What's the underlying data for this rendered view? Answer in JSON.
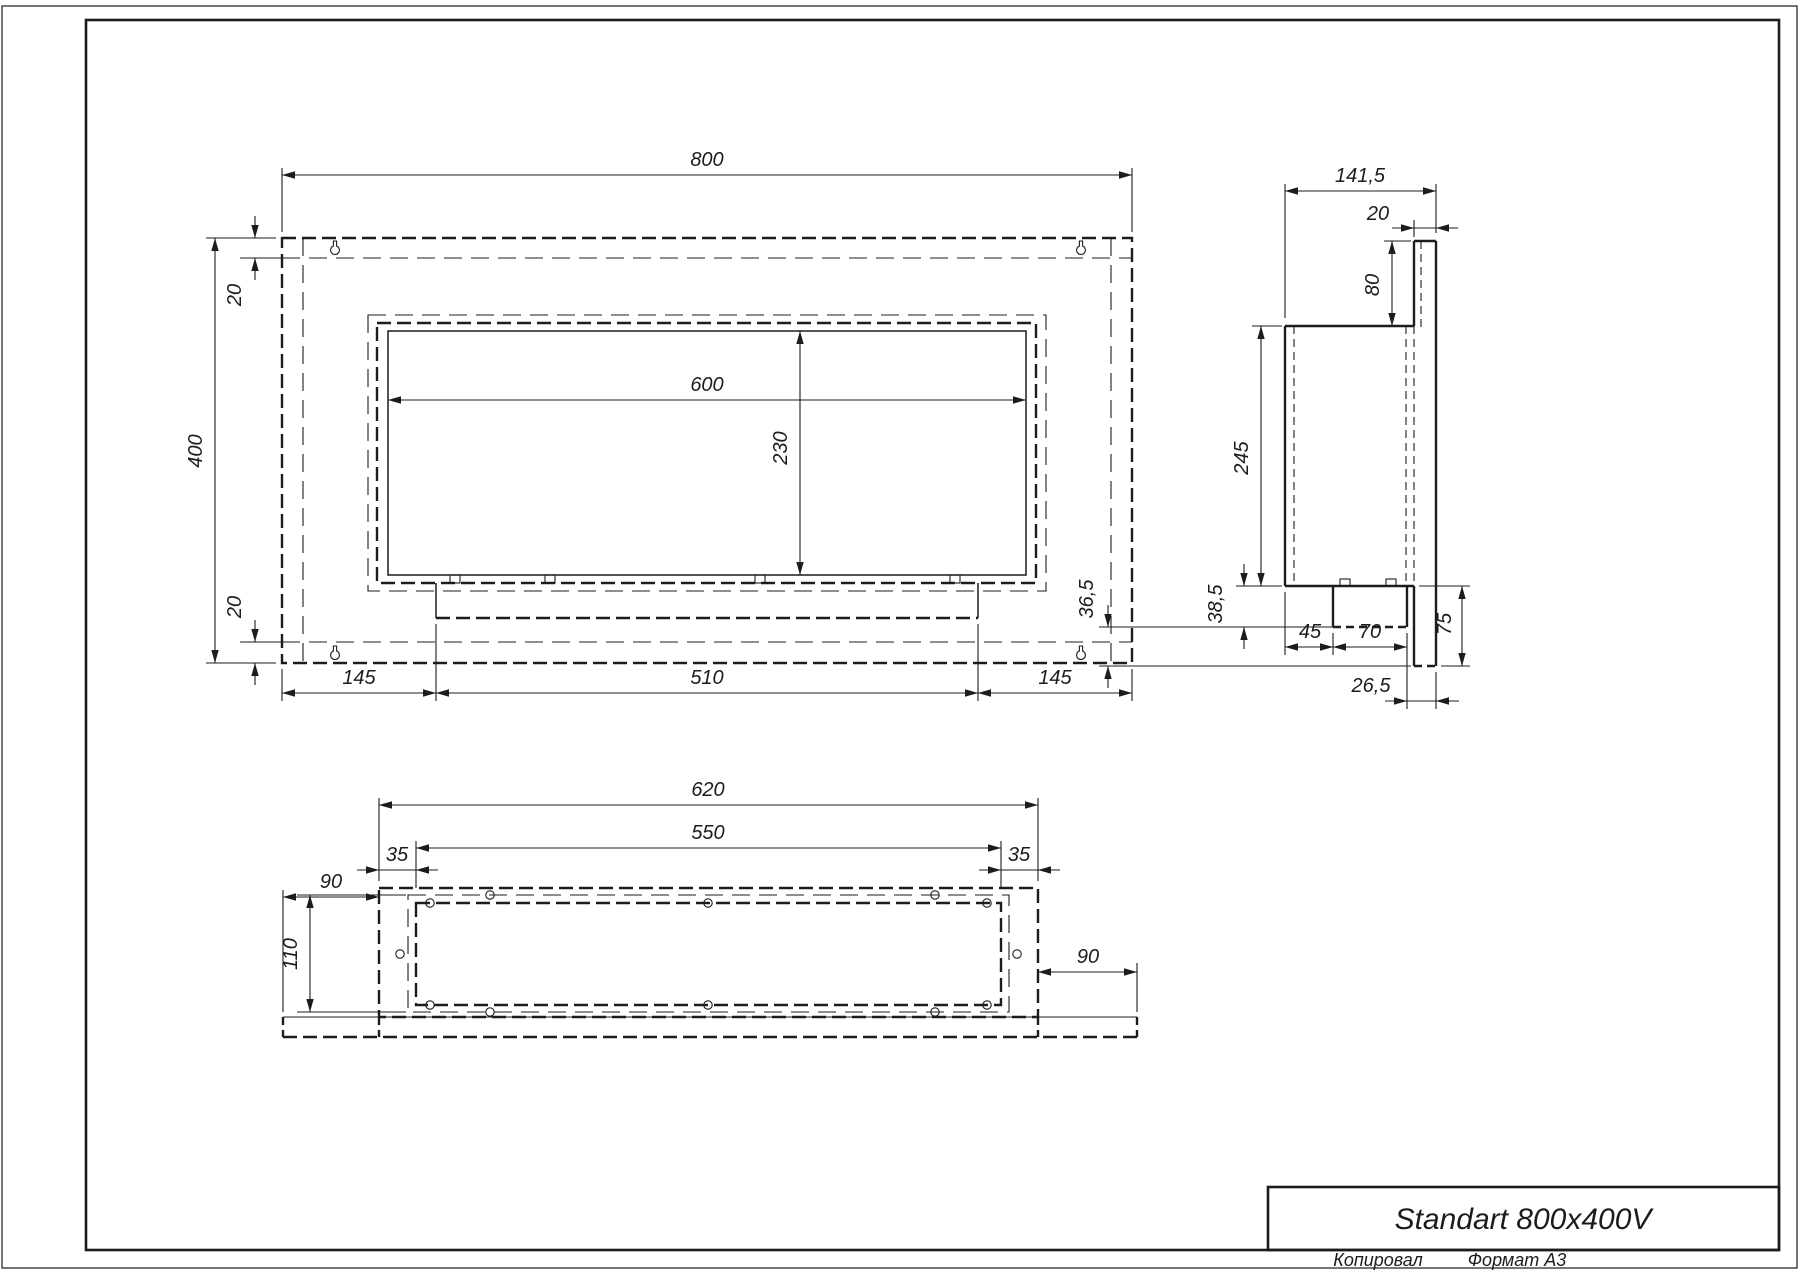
{
  "drawing": {
    "title": "Standart 800x400V",
    "footer": {
      "copied_by": "Копировал",
      "format": "Формат А3"
    },
    "colors": {
      "line": "#1c1c1c",
      "background": "#ffffff"
    },
    "front_view": {
      "overall_width": "800",
      "overall_height": "400",
      "top_inset": "20",
      "bottom_inset": "20",
      "opening_width": "600",
      "opening_height": "230",
      "left_offset": "145",
      "burner_width": "510",
      "right_offset": "145"
    },
    "side_view": {
      "overall_depth": "141,5",
      "back_panel_thickness": "20",
      "top_offset": "80",
      "body_height": "245",
      "front_lower_height": "38,5",
      "burner_front_offset": "45",
      "burner_depth": "70",
      "back_clearance": "26,5",
      "rear_lower_height": "36,5",
      "lower_back_height": "75"
    },
    "bottom_view": {
      "body_width": "620",
      "opening_width": "550",
      "left_inset": "35",
      "right_inset": "35",
      "plate_left_extension": "90",
      "opening_depth": "110",
      "plate_right_extension": "90"
    }
  }
}
